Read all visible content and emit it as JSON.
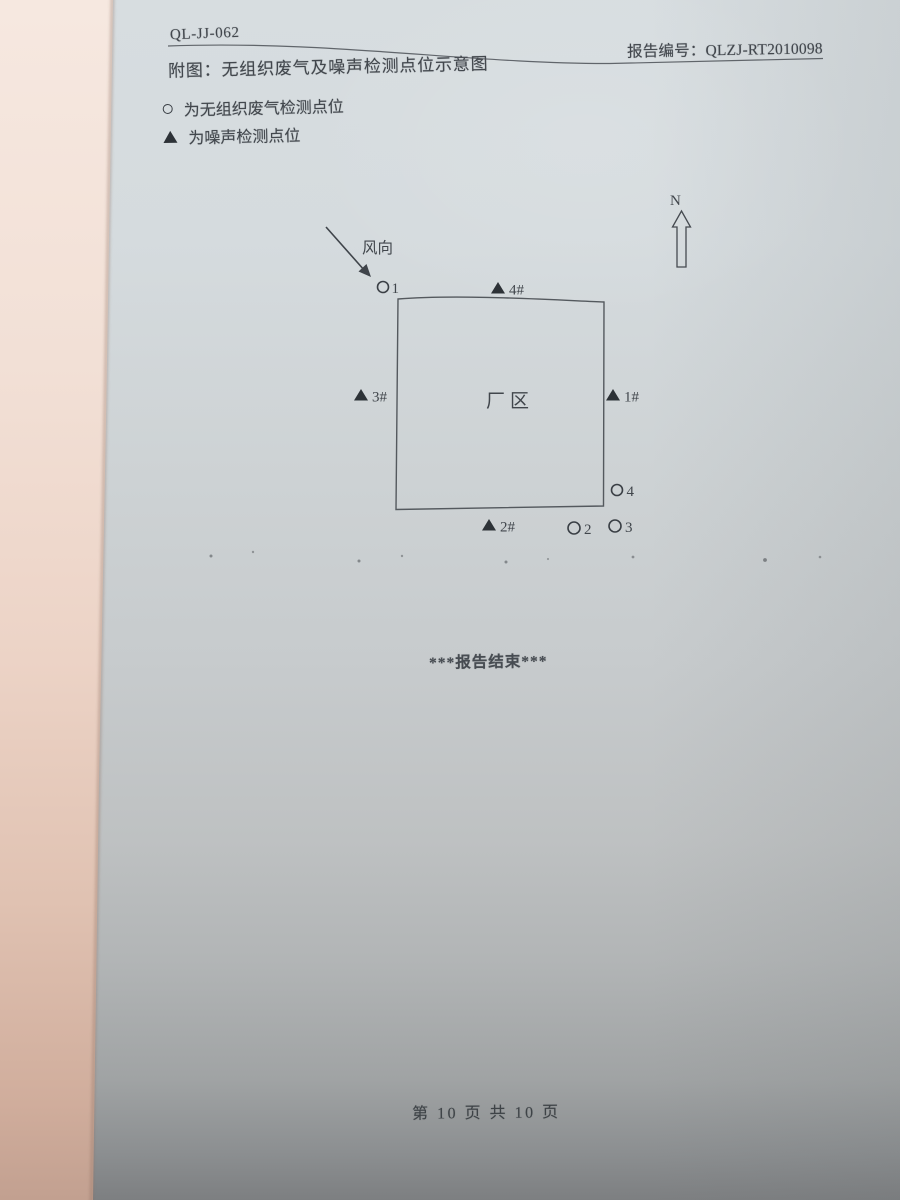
{
  "doc": {
    "form_code": "QL-JJ-062",
    "title": "附图：无组织废气及噪声检测点位示意图",
    "report_no": "报告编号：QLZJ-RT2010098",
    "end_text": "***报告结束***",
    "footer": "第 10 页  共 10 页"
  },
  "legend": {
    "gas_label": "为无组织废气检测点位",
    "noise_label": "为噪声检测点位"
  },
  "diagram": {
    "north_label": "N",
    "wind_label": "风向",
    "area_label": "厂区",
    "gas_points": {
      "p1": "1",
      "p2": "2",
      "p3": "3",
      "p4": "4"
    },
    "noise_points": {
      "n1": "1#",
      "n2": "2#",
      "n3": "3#",
      "n4": "4#"
    }
  },
  "colors": {
    "ink": "#42474d",
    "page_top": "#d7dde0",
    "page_bottom": "#7d7f81",
    "side_page": "#f2e0d6"
  }
}
